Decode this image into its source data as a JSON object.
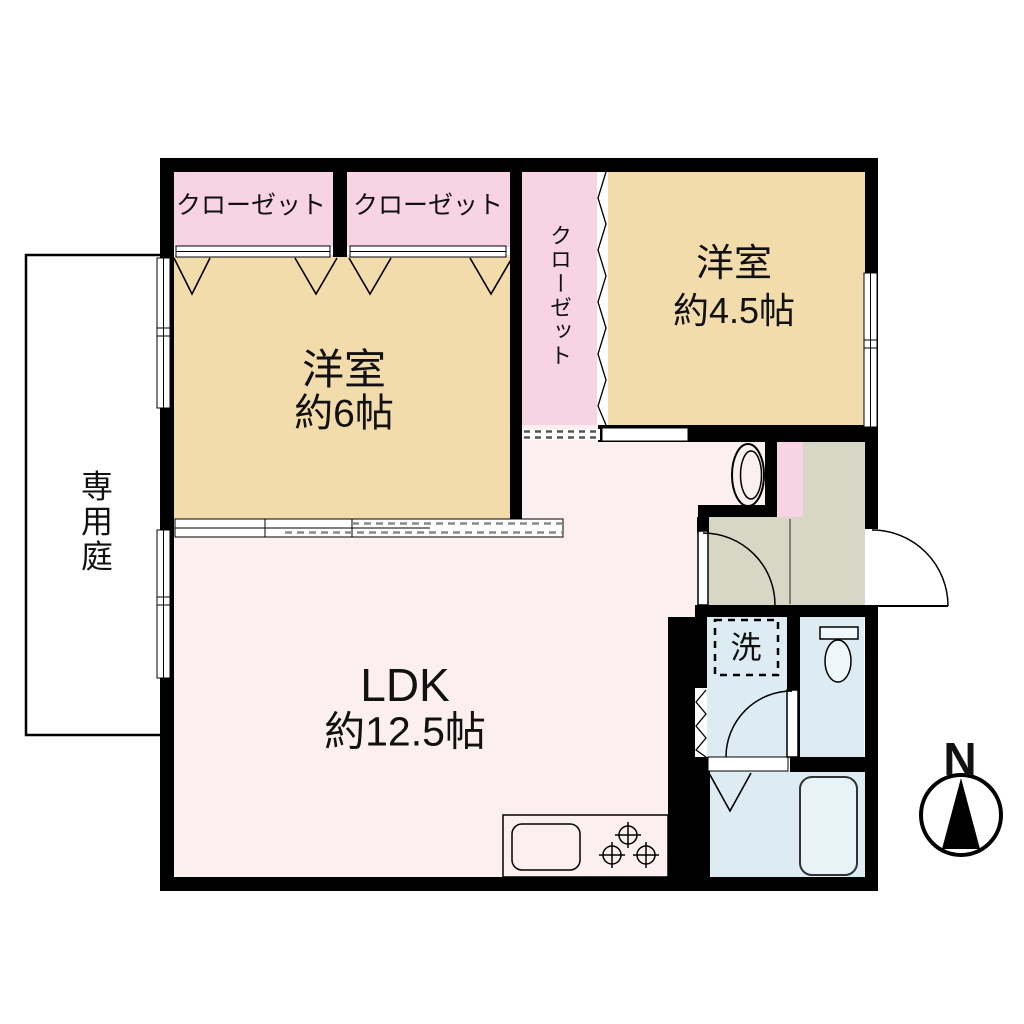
{
  "plan": {
    "title": "floor-plan",
    "rooms": {
      "western6": {
        "label": "洋室",
        "size": "約6帖"
      },
      "western45": {
        "label": "洋室",
        "size": "約4.5帖"
      },
      "ldk": {
        "label": "LDK",
        "size": "約12.5帖"
      }
    },
    "closets": {
      "top_left": "クローゼット",
      "top_middle": "クローゼット",
      "hall": "クローゼット"
    },
    "garden": {
      "label": "専用庭"
    },
    "fixtures": {
      "laundry": "洗"
    },
    "compass": {
      "label": "N"
    },
    "colors": {
      "wall": "#000000",
      "room_tan": "#f3dcab",
      "closet_pink": "#f8d3e3",
      "ldk_pink": "#fbeff0",
      "wet_blue": "#dcecf2",
      "hall_gray": "#d8d7c6",
      "tub_blue": "#e8f3f7"
    }
  }
}
